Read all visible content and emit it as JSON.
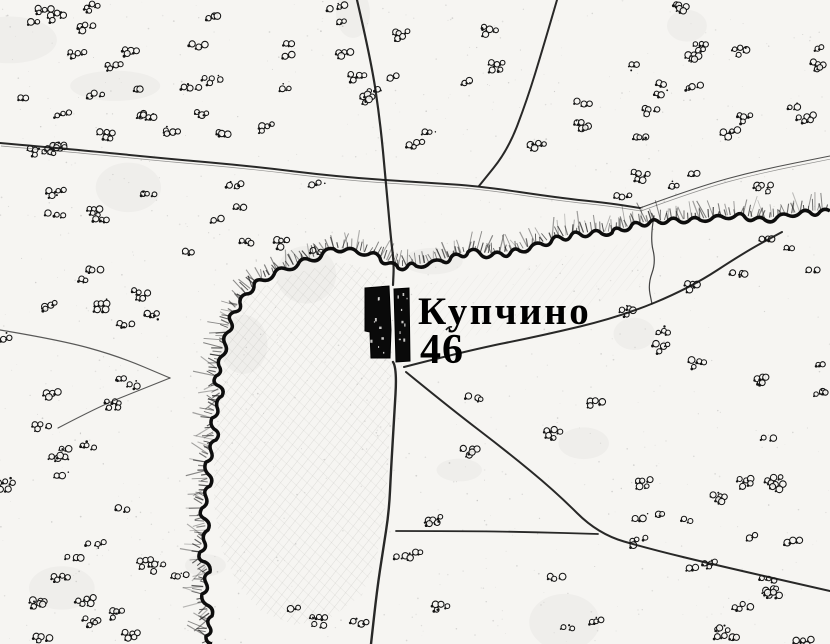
{
  "map": {
    "place_label": "Купчино",
    "house_number": "46",
    "colors": {
      "ink": "#141414",
      "paper": "#f6f5f2",
      "hatch": "#1c1c1c",
      "building": "#0a0a0a"
    }
  }
}
